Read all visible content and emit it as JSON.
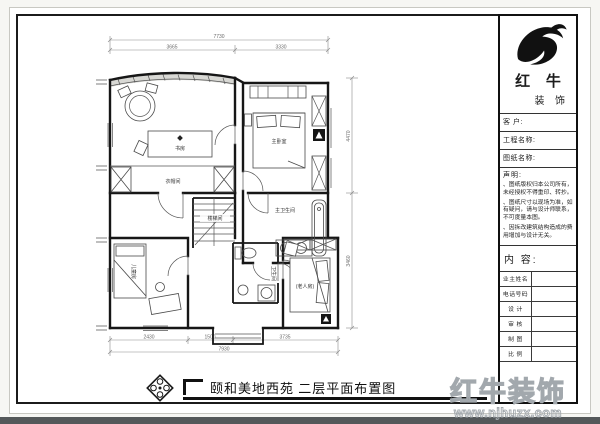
{
  "caption": {
    "title": "颐和美地西苑  二层平面布置图"
  },
  "watermark": {
    "brand": "红牛装饰",
    "url": "www.njhuzx.com"
  },
  "icons": {
    "logo": "bull-logo",
    "stamp": "diamond-stamp"
  },
  "plan": {
    "rooms": {
      "study": "书房",
      "cloakroom": "衣帽间",
      "stairwell": "楼梯间",
      "master_bedroom": "主卧室",
      "master_bathroom": "主卫生间",
      "bathroom": "卫生间",
      "kids_room": "儿童房",
      "elder_room": "(老人房)"
    },
    "dims": {
      "top_total": "7730",
      "top_left": "3665",
      "top_right": "3330",
      "bottom_1": "2430",
      "bottom_2": "1500",
      "bottom_3": "3735",
      "bottom_total": "7930",
      "right_1": "4470",
      "right_2": "3460"
    }
  },
  "title_block": {
    "brand_main": "红 牛",
    "brand_sub": "装 饰",
    "fields": [
      "客  户:",
      "工程名称:",
      "图纸名称:"
    ],
    "statement_title": "声明:",
    "statement_items": [
      "、图纸版权归本公司所有，未经授权不得重印、转抄。",
      "、图纸尺寸以现场为准，如有疑问，请与设计师联系，不可度量本图。",
      "、因拆改建筑结构造成的费用增加与设计无关。"
    ],
    "content_label": "内 容:",
    "rows": [
      "业主姓名",
      "电话号码",
      "设 计",
      "审 核",
      "制 图",
      "比 例"
    ]
  }
}
